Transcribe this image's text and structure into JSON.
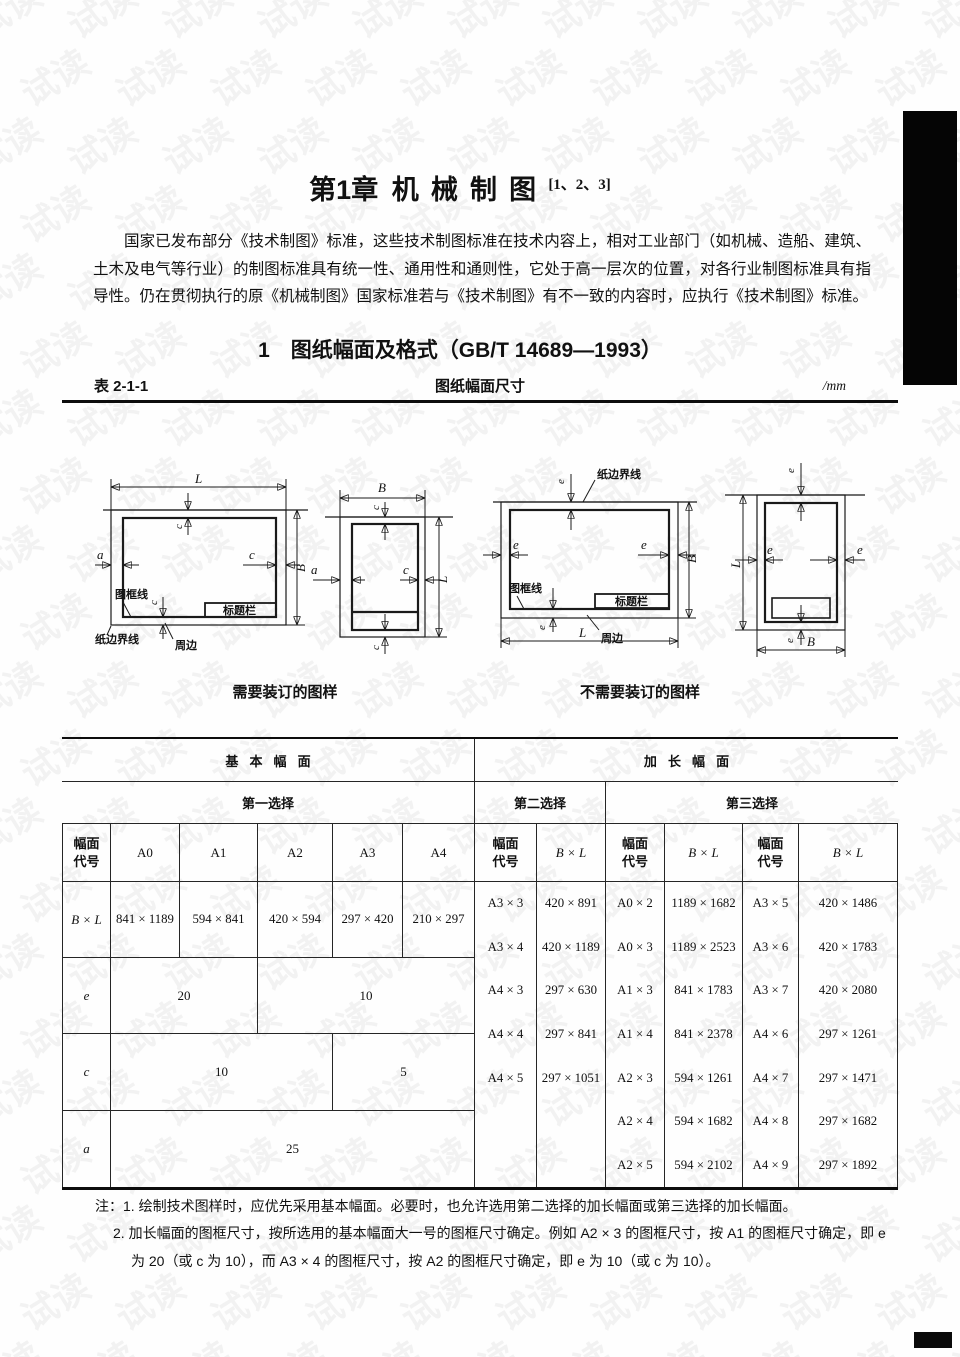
{
  "page": {
    "chapter_prefix": "第1章",
    "chapter_name": "机械制图",
    "chapter_sup": "[1、2、3]",
    "intro_paragraph": "国家已发布部分《技术制图》标准，这些技术制图标准在技术内容上，相对工业部门（如机械、造船、建筑、土木及电气等行业）的制图标准具有统一性、通用性和通则性，它处于高一层次的位置，对各行业制图标准具有指导性。仍在贯彻执行的原《机械制图》国家标准若与《技术制图》有不一致的内容时，应执行《技术制图》标准。",
    "section_heading": "1　图纸幅面及格式（GB/T 14689—1993）",
    "watermark_text": "试读"
  },
  "caption": {
    "label": "表 2-1-1",
    "title": "图纸幅面尺寸",
    "unit": "/mm"
  },
  "figures": {
    "labels": {
      "L": "L",
      "B": "B",
      "a": "a",
      "c": "c",
      "e": "e",
      "frame_line": "图框线",
      "title_block": "标题栏",
      "paper_edge": "纸边界线",
      "margin": "周边"
    },
    "caption_binding": "需要装订的图样",
    "caption_no_binding": "不需要装订的图样"
  },
  "table": {
    "header": {
      "basic": "基本幅面",
      "extended": "加长幅面",
      "first": "第一选择",
      "second": "第二选择",
      "third": "第三选择",
      "code": "幅面代号",
      "bxl": "B × L",
      "sizes": [
        "A0",
        "A1",
        "A2",
        "A3",
        "A4"
      ]
    },
    "left": {
      "bxl_label": "B × L",
      "bxl_values": [
        "841 × 1189",
        "594 × 841",
        "420 × 594",
        "297 × 420",
        "210 × 297"
      ],
      "e_label": "e",
      "e_v1": "20",
      "e_v2": "10",
      "c_label": "c",
      "c_v1": "10",
      "c_v2": "5",
      "a_label": "a",
      "a_v1": "25"
    },
    "right_rows": [
      [
        "A3 × 3",
        "420 × 891",
        "A0 × 2",
        "1189 × 1682",
        "A3 × 5",
        "420 × 1486"
      ],
      [
        "A3 × 4",
        "420 × 1189",
        "A0 × 3",
        "1189 × 2523",
        "A3 × 6",
        "420 × 1783"
      ],
      [
        "A4 × 3",
        "297 × 630",
        "A1 × 3",
        "841 × 1783",
        "A3 × 7",
        "420 × 2080"
      ],
      [
        "A4 × 4",
        "297 × 841",
        "A1 × 4",
        "841 × 2378",
        "A4 × 6",
        "297 × 1261"
      ],
      [
        "A4 × 5",
        "297 × 1051",
        "A2 × 3",
        "594 × 1261",
        "A4 × 7",
        "297 × 1471"
      ],
      [
        "",
        "",
        "A2 × 4",
        "594 × 1682",
        "A4 × 8",
        "297 × 1682"
      ],
      [
        "",
        "",
        "A2 × 5",
        "594 × 2102",
        "A4 × 9",
        "297 × 1892"
      ]
    ]
  },
  "notes": {
    "prefix": "注：",
    "items": [
      "1. 绘制技术图样时，应优先采用基本幅面。必要时，也允许选用第二选择的加长幅面或第三选择的加长幅面。",
      "2. 加长幅面的图框尺寸，按所选用的基本幅面大一号的图框尺寸确定。例如 A2 × 3 的图框尺寸，按 A1 的图框尺寸确定，即 e 为 20（或 c 为 10），而 A3 × 4 的图框尺寸，按 A2 的图框尺寸确定，即 e 为 10（或 c 为 10）。"
    ]
  }
}
